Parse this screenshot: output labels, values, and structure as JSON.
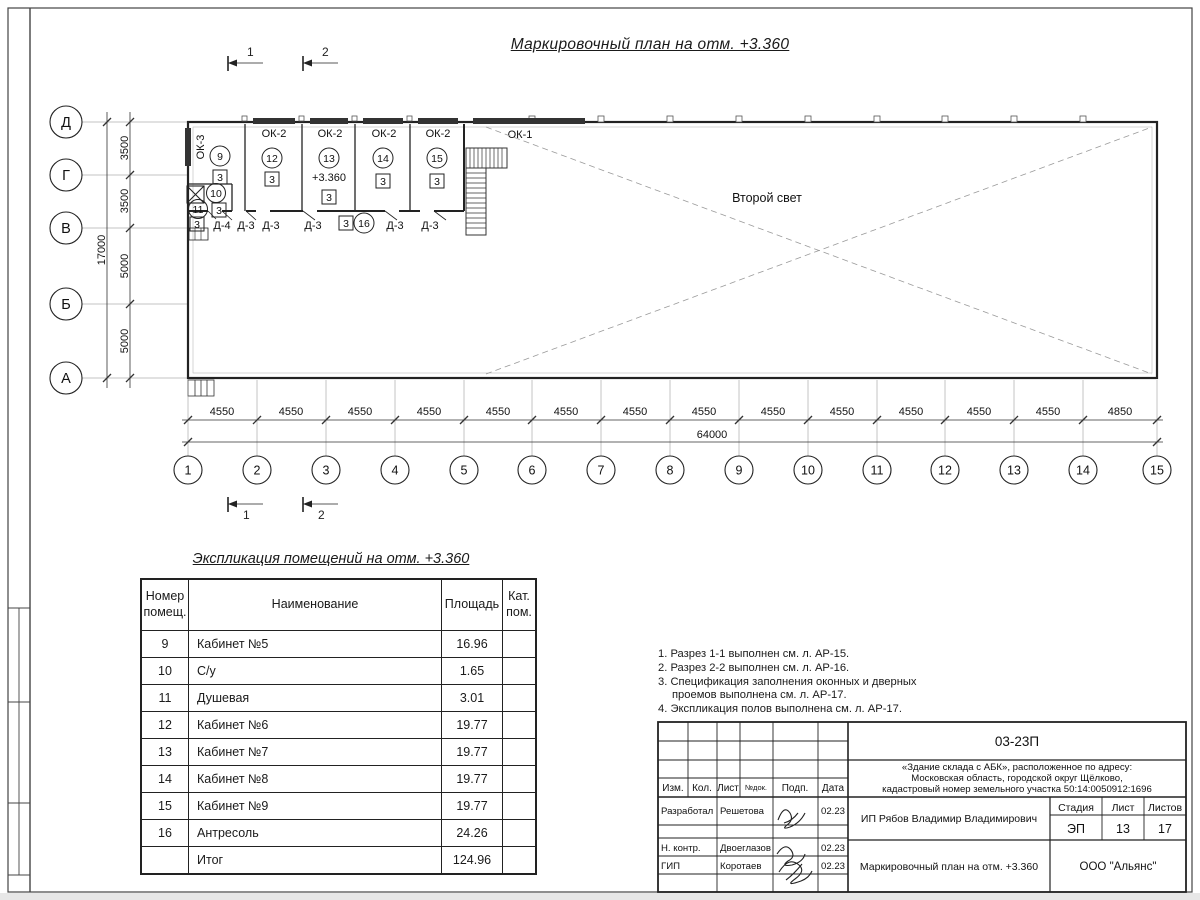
{
  "sheet": {
    "title": "Маркировочный план на отм. +3.360"
  },
  "plan": {
    "section_marks": [
      "1",
      "2"
    ],
    "axis_rows": [
      "Д",
      "Г",
      "В",
      "Б",
      "А"
    ],
    "axis_cols": [
      "1",
      "2",
      "3",
      "4",
      "5",
      "6",
      "7",
      "8",
      "9",
      "10",
      "11",
      "12",
      "13",
      "14",
      "15"
    ],
    "v_dims": [
      "3500",
      "3500",
      "5000",
      "5000"
    ],
    "v_total": "17000",
    "h_dims": [
      "4550",
      "4550",
      "4550",
      "4550",
      "4550",
      "4550",
      "4550",
      "4550",
      "4550",
      "4550",
      "4550",
      "4550",
      "4550",
      "4850"
    ],
    "h_total": "64000",
    "windows": {
      "ok1": "ОК-1",
      "ok2": "ОК-2",
      "ok3": "ОК-3"
    },
    "rooms": {
      "r9": {
        "num": "9",
        "cat": "3"
      },
      "r10": {
        "num": "10",
        "cat": "3"
      },
      "r11": {
        "num": "11",
        "cat": "3"
      },
      "r12": {
        "num": "12",
        "cat": "3"
      },
      "r13": {
        "num": "13",
        "cat": "3"
      },
      "r14": {
        "num": "14",
        "cat": "3"
      },
      "r15": {
        "num": "15",
        "cat": "3"
      },
      "r16": {
        "num": "16",
        "cat": "3"
      }
    },
    "elevation": "+3.360",
    "second_light": "Второй свет",
    "doors": [
      "Д-4",
      "Д-3",
      "Д-3",
      "Д-3",
      "Д-3",
      "Д-3"
    ]
  },
  "explication": {
    "title": "Экспликация помещений на отм. +3.360",
    "headers": {
      "num1": "Номер",
      "num2": "помещ.",
      "name": "Наименование",
      "area": "Площадь",
      "cat1": "Кат.",
      "cat2": "пом."
    },
    "rows": [
      {
        "num": "9",
        "name": "Кабинет №5",
        "area": "16.96"
      },
      {
        "num": "10",
        "name": "С/у",
        "area": "1.65"
      },
      {
        "num": "11",
        "name": "Душевая",
        "area": "3.01"
      },
      {
        "num": "12",
        "name": "Кабинет №6",
        "area": "19.77"
      },
      {
        "num": "13",
        "name": "Кабинет №7",
        "area": "19.77"
      },
      {
        "num": "14",
        "name": "Кабинет №8",
        "area": "19.77"
      },
      {
        "num": "15",
        "name": "Кабинет №9",
        "area": "19.77"
      },
      {
        "num": "16",
        "name": "Антресоль",
        "area": "24.26"
      }
    ],
    "total": {
      "name": "Итог",
      "area": "124.96"
    }
  },
  "notes": [
    "1. Разрез 1-1 выполнен см. л. АР-15.",
    "2. Разрез 2-2 выполнен см. л. АР-16.",
    "3. Спецификация заполнения оконных и дверных",
    "проемов выполнена см. л. АР-17.",
    "4. Экспликация полов выполнена см. л. АР-17."
  ],
  "titleblock": {
    "doc_number": "03-23П",
    "object_line1": "«Здание склада с АБК», расположенное по адресу:",
    "object_line2": "Московская область, городской округ Щёлково,",
    "object_line3": "кадастровый номер земельного участка 50:14:0050912:1696",
    "cols": [
      "Изм.",
      "Кол.",
      "Лист",
      "№док.",
      "Подп.",
      "Дата"
    ],
    "rows": [
      {
        "role": "Разработал",
        "name": "Решетова",
        "date": "02.23"
      },
      {
        "role": "Н. контр.",
        "name": "Двоеглазов",
        "date": "02.23"
      },
      {
        "role": "ГИП",
        "name": "Коротаев",
        "date": "02.23"
      }
    ],
    "client": "ИП Рябов Владимир Владимирович",
    "stage_label": "Стадия",
    "sheet_label": "Лист",
    "sheets_label": "Листов",
    "stage": "ЭП",
    "sheet_num": "13",
    "sheets_total": "17",
    "drawing_title": "Маркировочный план на отм. +3.360",
    "company": "ООО \"Альянс\""
  }
}
